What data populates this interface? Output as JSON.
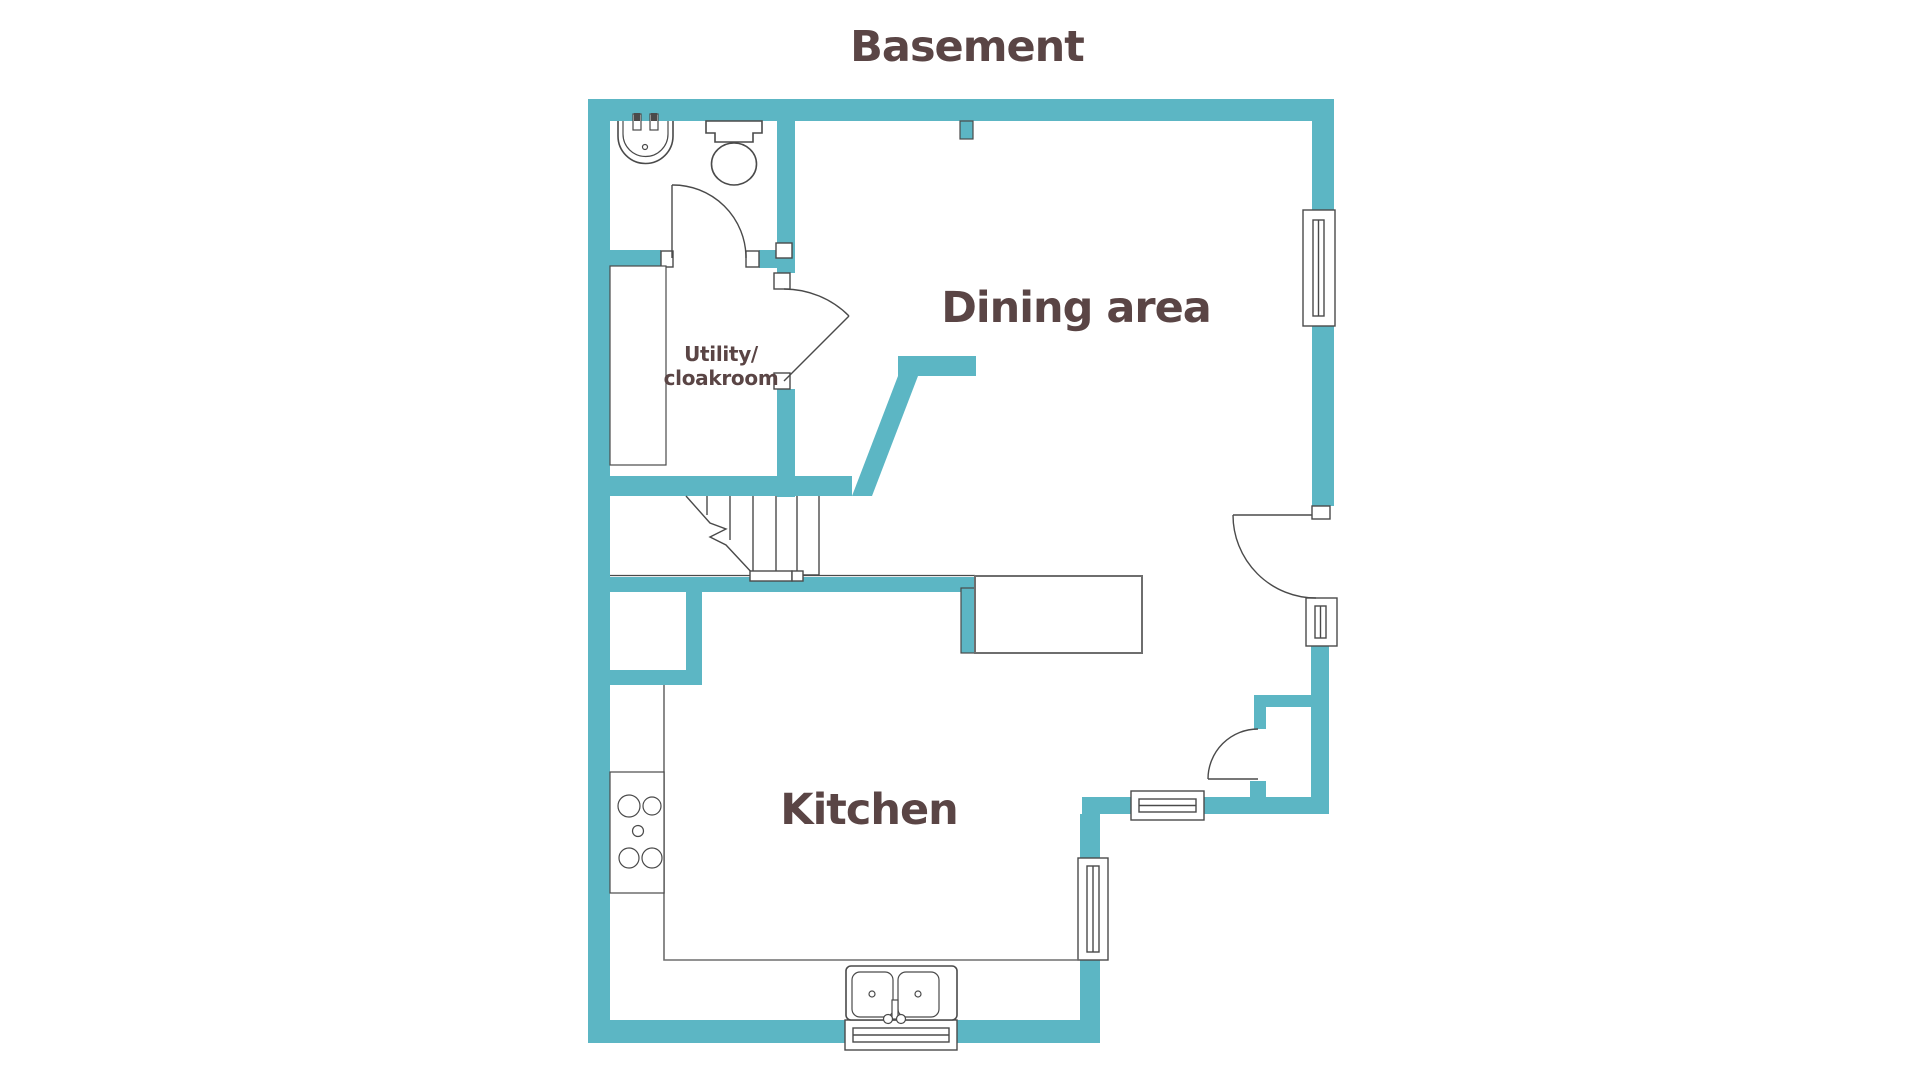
{
  "title": "Basement",
  "rooms": {
    "dining": {
      "label": "Dining area"
    },
    "kitchen": {
      "label": "Kitchen"
    },
    "utility": {
      "label_line1": "Utility/",
      "label_line2": "cloakroom"
    }
  },
  "colors": {
    "wall": "#5cb6c4",
    "outline": "#4a4a4a",
    "counter_outline": "#6e6e6e",
    "text": "#5a4545",
    "background": "#ffffff"
  }
}
